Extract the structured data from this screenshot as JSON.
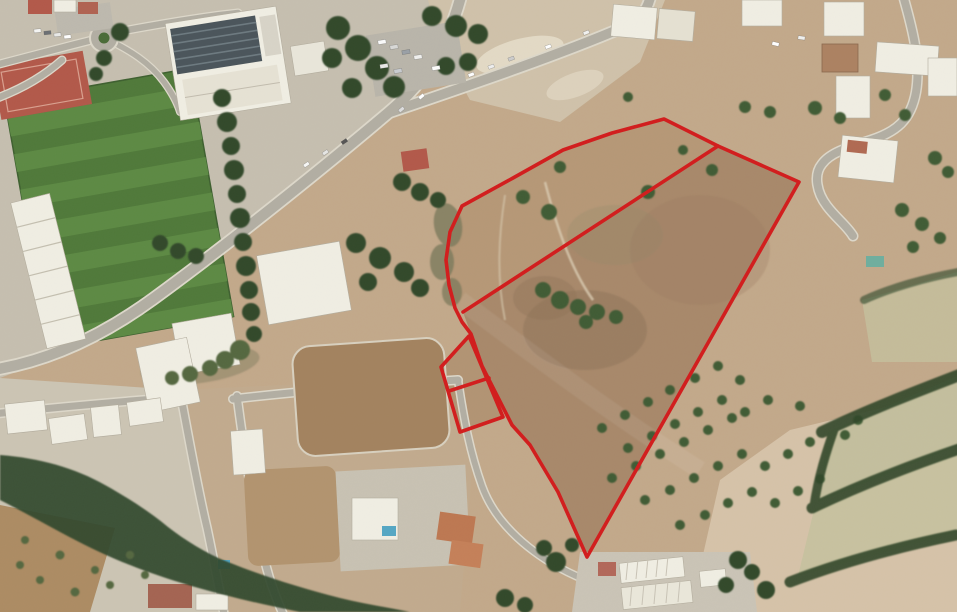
{
  "scene": {
    "type": "satellite-aerial-photo",
    "description": "Aerial satellite view of a town edge: sports field, school and commercial buildings to the west, roads, villas, and open brown farmland to the east on which land parcels are outlined in red.",
    "palette": {
      "farm_tan": "#c3a98b",
      "urban_gray": "#c6bfb0",
      "villas_gray": "#ccc5b4",
      "lots_tan": "#c2ab8e",
      "parcel_main": "#a8896b",
      "parcel_band": "#b69877",
      "annex_fill": "#b29474",
      "pitch_green": "#50793a",
      "pitch_stripe": "#5d8a44",
      "road_gray": "#b2aea3",
      "road_edge": "#ddd8ca",
      "building_white": "#f0eee3",
      "roof_dark": "#4b555b",
      "terracotta": "#b2594a",
      "tree_dark": "#31482b",
      "tree_mid": "#3f5c35",
      "tree_olive": "#55673f",
      "scrub_olive": "#7c7a5c",
      "dirt_lot": "#a3835f",
      "pale_field": "#d6c3a9",
      "pale_green": "#c4bf9e",
      "bare_pale": "#d0c2aa",
      "brown_field": "#ad8c64",
      "pool_blue": "#55a7c4",
      "overlay_red": "#d21d1d"
    }
  },
  "overlay": {
    "label": "parcel-boundary",
    "stroke_width": 3.6,
    "main_parcel_points": "664,119 718,146 799,182 587,557 558,492 530,445 512,425 482,366 471,334 462,322 455,308 449,285 446,260 450,232 462,206 513,178 563,150 612,133",
    "division_line_points": "718,146 463,312",
    "annex_points": "469,336 441,367 460,432 503,417",
    "annex_divider_points": "449,391 489,378",
    "region_band_points": "664,119 718,146 463,312 455,308 449,285 446,260 450,232 462,206 513,178 563,150 612,133",
    "region_main_points": "718,146 799,182 587,557 558,492 530,445 512,425 482,366 471,334 463,312"
  }
}
